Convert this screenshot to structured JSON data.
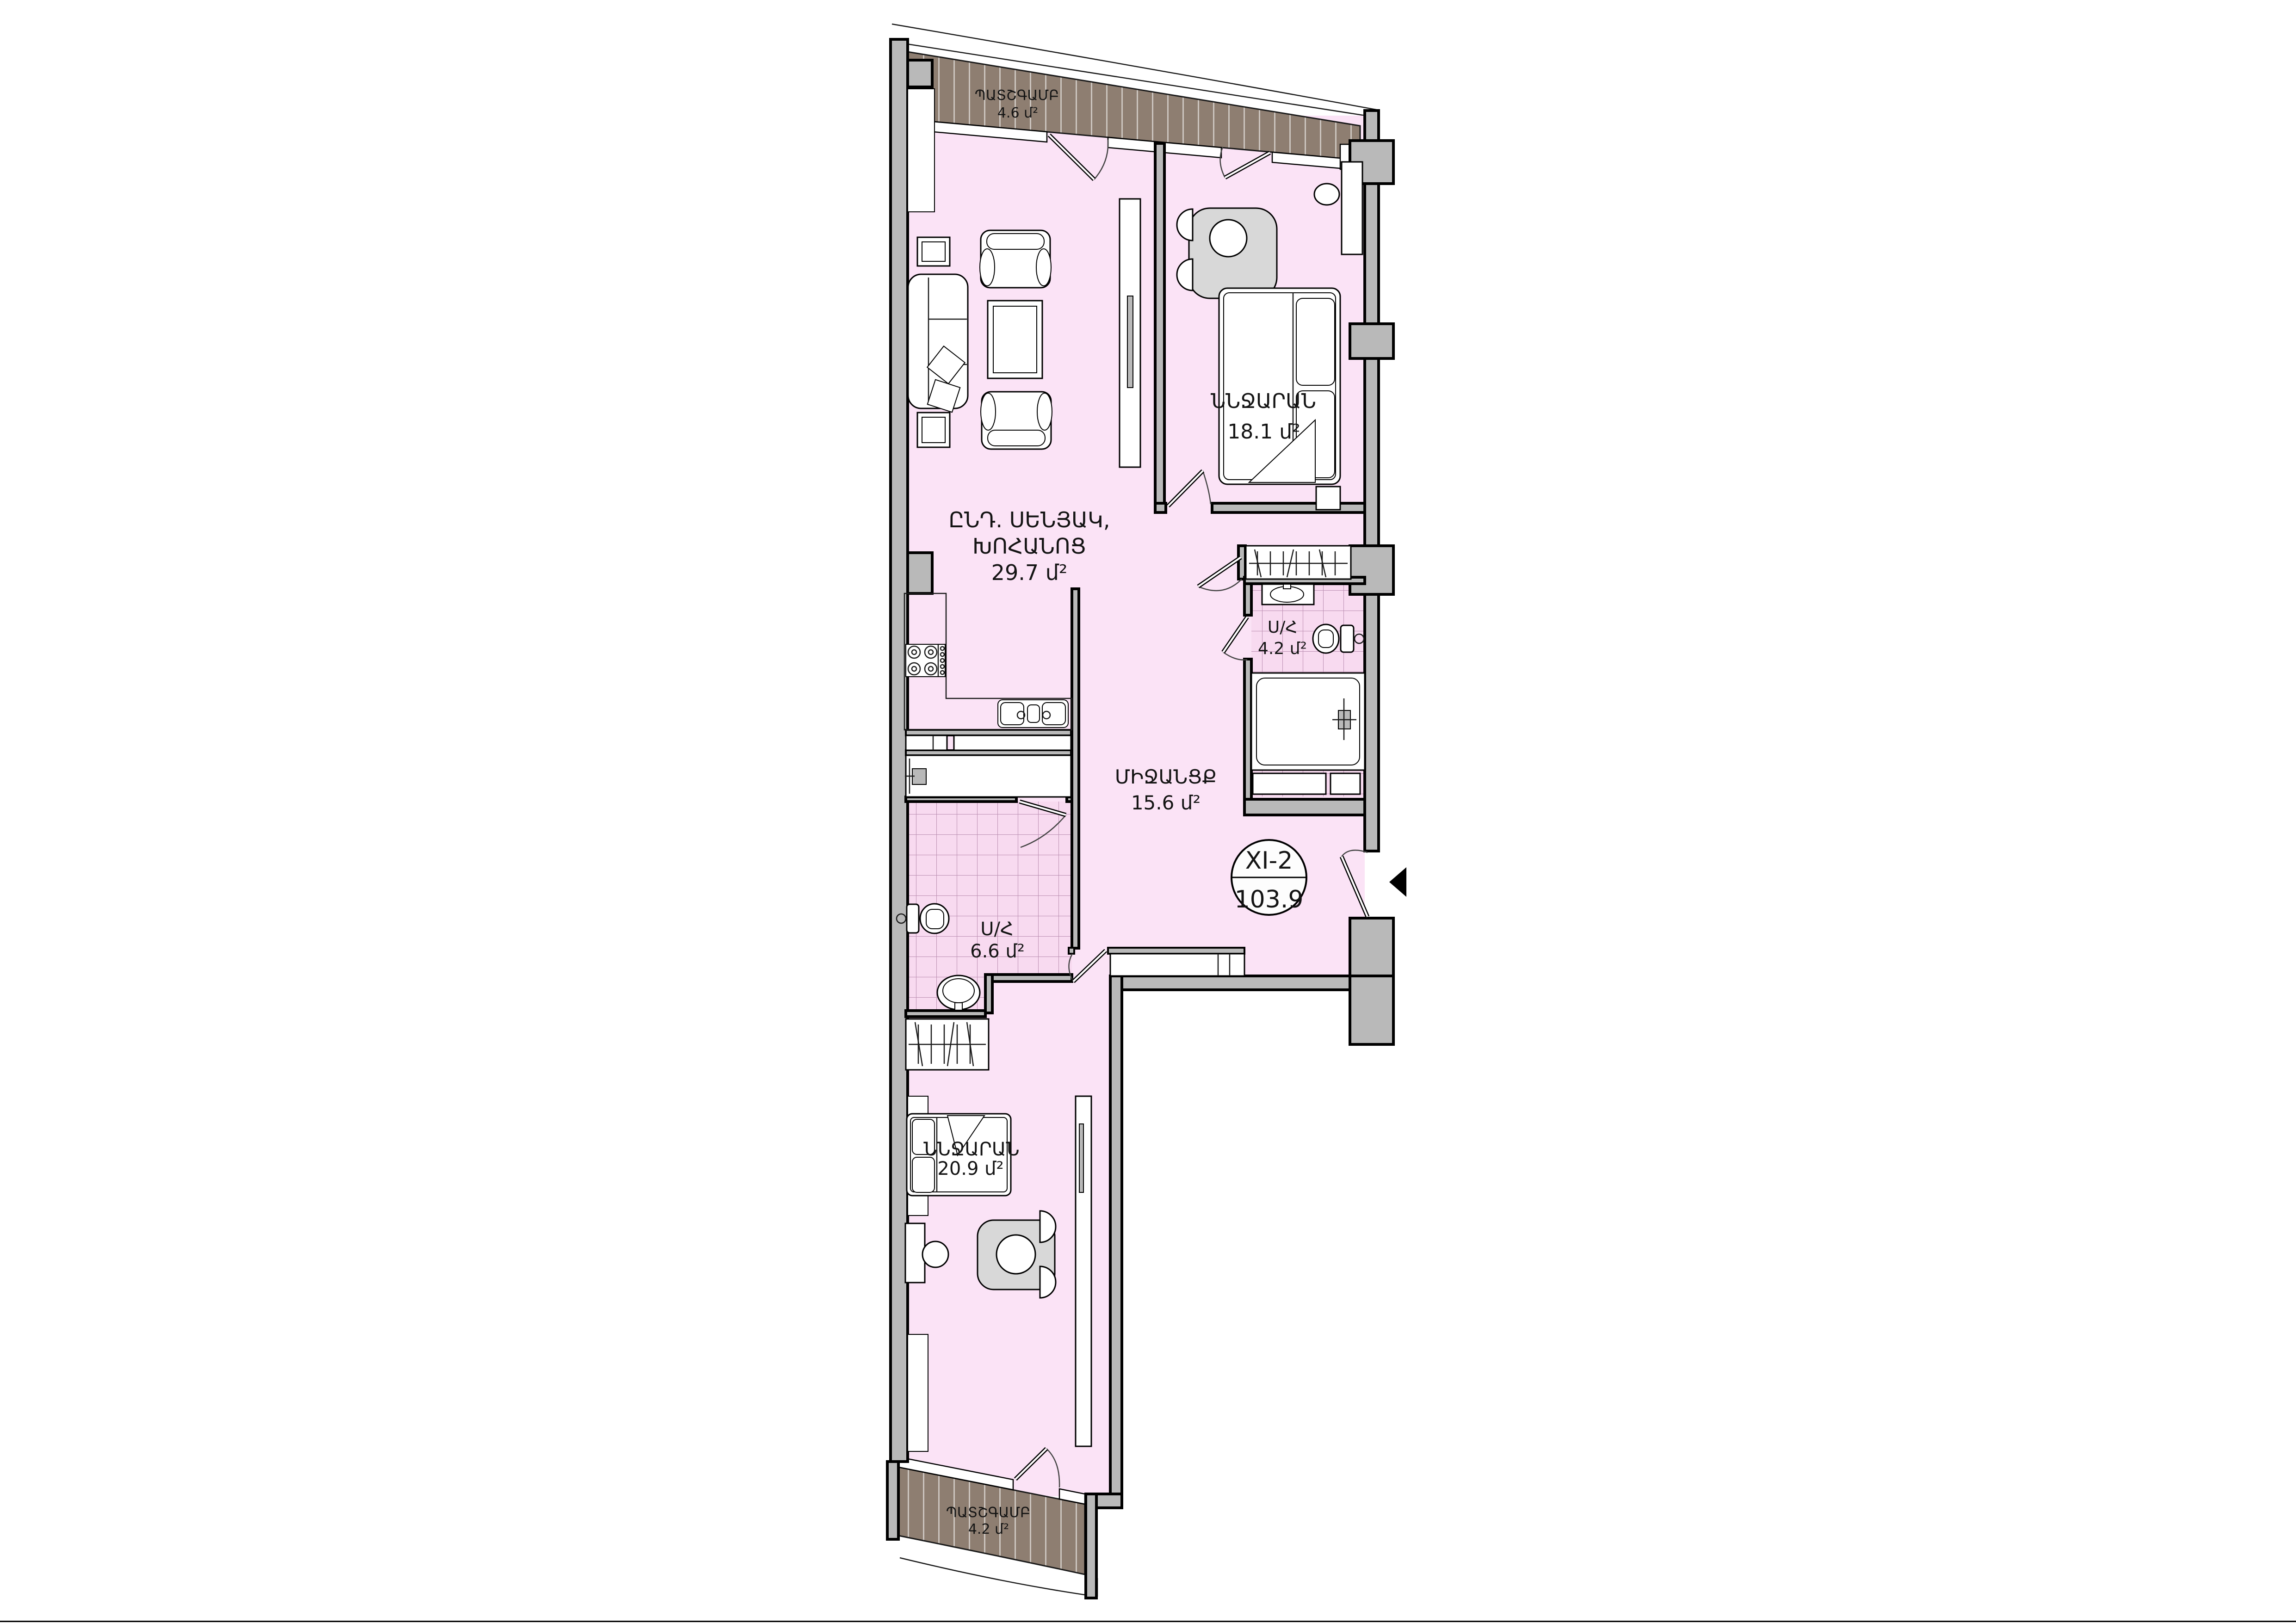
{
  "plan": {
    "unit_badge": {
      "unit": "XI-2",
      "area": "103.9"
    },
    "rooms": {
      "balcony_top": {
        "name": "ՊԱՏՇԳԱՄԲ",
        "area": "4.6 մ²"
      },
      "living_kitchen": {
        "name_line1": "ԸՆԴ. ՍԵՆՅԱԿ,",
        "name_line2": "ԽՈՀԱՆՈՑ",
        "area": "29.7 մ²"
      },
      "bedroom_top": {
        "name": "ՆՆՋԱՐԱՆ",
        "area": "18.1 մ²"
      },
      "bathroom_small": {
        "name": "Ս/Հ",
        "area": "4.2 մ²"
      },
      "hallway": {
        "name": "ՄԻՋԱՆՑՔ",
        "area": "15.6 մ²"
      },
      "bathroom_large": {
        "name": "Ս/Հ",
        "area": "6.6 մ²"
      },
      "bedroom_bottom": {
        "name": "ՆՆՋԱՐԱՆ",
        "area": "20.9 մ²"
      },
      "balcony_bottom": {
        "name": "ՊԱՏՇԳԱՄԲ",
        "area": "4.2 մ²"
      }
    },
    "colors": {
      "floor": "#fbe3f6",
      "tile": "#f8daf0",
      "wall": "#b9b9b9",
      "deck": "#8e7e71",
      "outline": "#000000"
    }
  }
}
